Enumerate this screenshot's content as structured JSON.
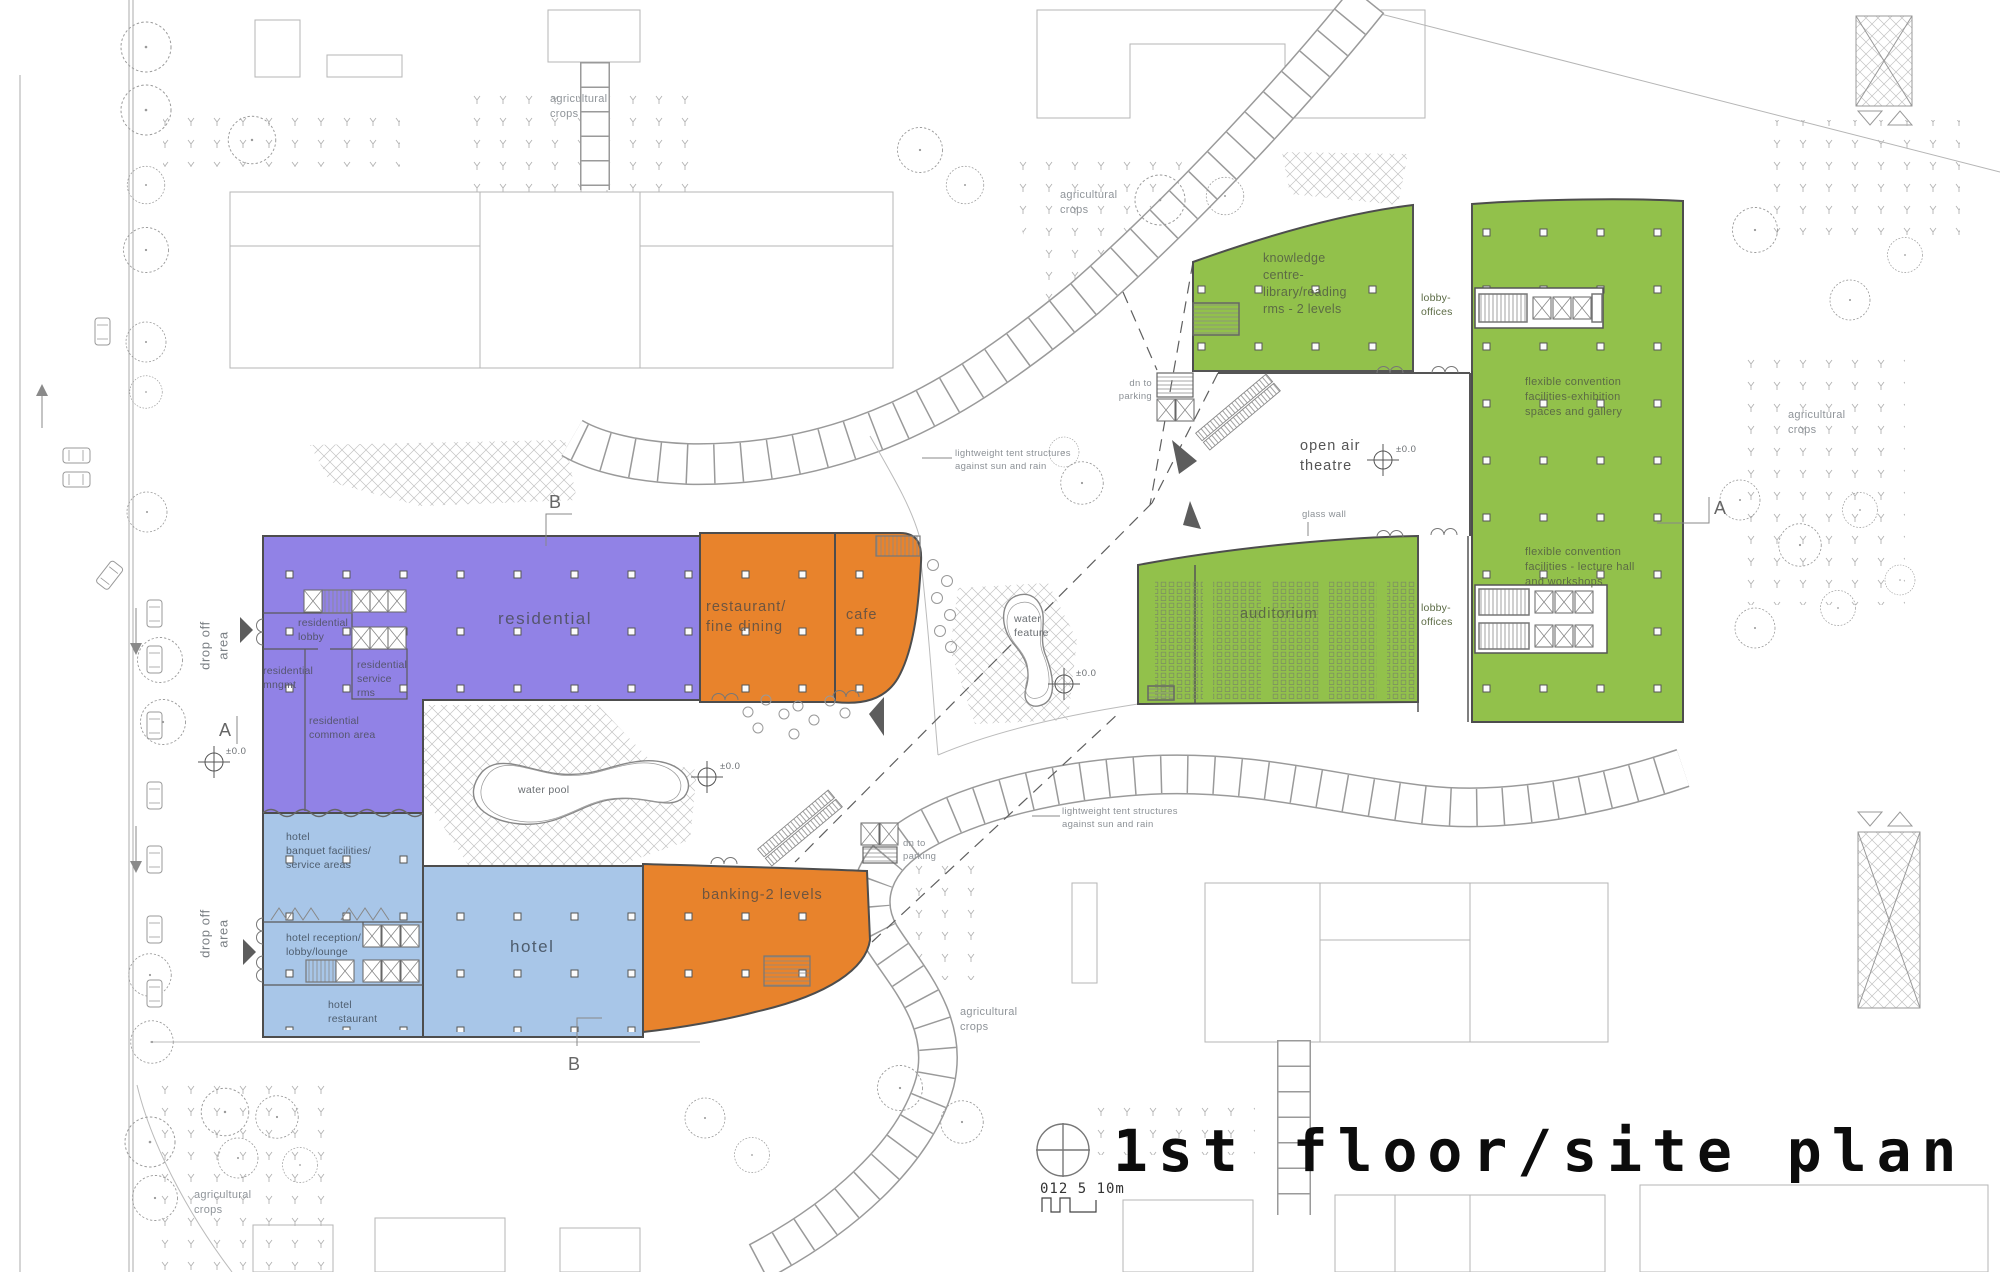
{
  "title": "1st floor/site plan",
  "scale_bar": {
    "label": "012 5    10m"
  },
  "section_markers": {
    "a": "A",
    "b": "B"
  },
  "site_labels": {
    "agricultural_crops": "agricultural\ncrops",
    "tent_structures": "lightweight tent structures\nagainst sun and rain",
    "dn_to_parking": "dn to\nparking",
    "drop_off_area": "drop off\narea",
    "glass_wall": "glass wall",
    "water_feature": "water\nfeature",
    "water_pool": "water pool",
    "elevation_marker": "±0.0"
  },
  "zones": {
    "residential": {
      "label": "residential",
      "color": "#9182e6",
      "rooms": {
        "lobby": "residential\nlobby",
        "management": "residential\nmngmt",
        "service": "residential\nservice\nrms",
        "common": "residential\ncommon area"
      }
    },
    "restaurant_fine_dining": {
      "label": "restaurant/\nfine dining",
      "color": "#e8832c"
    },
    "cafe": {
      "label": "cafe",
      "color": "#e8832c"
    },
    "banking": {
      "label": "banking-2 levels",
      "color": "#e8832c"
    },
    "hotel": {
      "label": "hotel",
      "color": "#a8c6e8",
      "rooms": {
        "banquet": "hotel\nbanquet facilities/\nservice areas",
        "reception": "hotel reception/\nlobby/lounge",
        "restaurant": "hotel\nrestaurant"
      }
    },
    "knowledge_centre": {
      "label": "knowledge\ncentre-\nlibrary/reading\nrms - 2 levels",
      "color": "#92c14b"
    },
    "lobby_offices": {
      "label": "lobby-\noffices"
    },
    "convention_exhibition": {
      "label": "flexible convention\nfacilities-exhibition\nspaces and gallery",
      "color": "#92c14b"
    },
    "convention_lecture": {
      "label": "flexible convention\nfacilities - lecture hall\nand workshops"
    },
    "auditorium": {
      "label": "auditorium",
      "color": "#92c14b"
    },
    "open_air_theatre": {
      "label": "open air\ntheatre"
    }
  }
}
